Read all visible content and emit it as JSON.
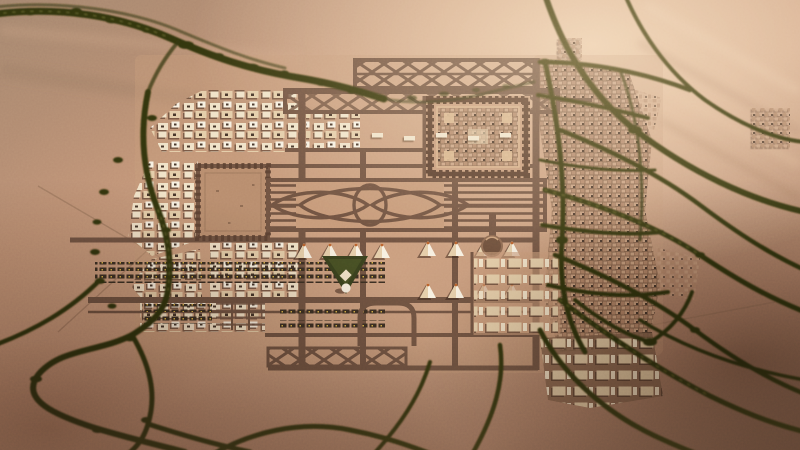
{
  "scene": {
    "title": "Aerial golden-hour view of a desert master-planned city: rectilinear new-town grid with walled citadel, ornamental garden band, tent rows and market strips, flanked by an organic old town and dark tree-lined wadi roads branching across the sand",
    "type": "aerial-photograph-render",
    "environment": "desert",
    "time_of_day": "golden hour"
  },
  "palette": {
    "desertLight": "#e9c6a4",
    "desertWarm": "#cda084",
    "desertBase": "#bb9078",
    "desertShade": "#8c6e5c",
    "desertDark": "#53392b",
    "road": "#6f5342",
    "roadDark": "#573e2f",
    "groundPad": "#c69a7a",
    "cream": "#f0e2c8",
    "creamSoft": "#e4cda9",
    "white": "#f7f0e1",
    "roof": "#45352a",
    "tan": "#c9a183",
    "tan2": "#b1876a",
    "oldBase": "#7e5f49",
    "green": "#31350f",
    "moss": "#5c5d26",
    "parkGreen": "#39411e",
    "plaza": "#b78c6e",
    "accentOrange": "#b9622d",
    "stallDark": "#3b2f23",
    "stallDot": "#d8b24a",
    "shadow": "rgba(58,39,27,0.55)",
    "wallLight": "#dcb78e"
  },
  "features": {
    "vegetation_band_top": "dark shrub band arcing along the north-west dunes",
    "west_wadi": "tree-lined wadi skirting the west edge of the grid",
    "delta_branches": "branching dark wadi channels fanning across the south-west desert",
    "highway_web": "curving tree-lined roads webbing the eastern desert",
    "citadel": "square crenellated-wall compound enclosing dense old fabric",
    "plaza": "large empty walled plaza",
    "braid_band": "striped garden band with interlaced ellipse parterre",
    "truss_bands": "criss-cross lattice road bands on the north edge",
    "tent_rows": "rows of white pavilion tents",
    "market_strips": "long stall rows dotted with awnings",
    "park_triangle": "green triangular park with white landmark",
    "dome_landmark": "round domed landmark on a stem road",
    "warehouse_grid": "grid of pale warehouse slabs",
    "old_town": "fine-grain organic city fabric on the east side",
    "bright_quarter": "sunlit pale block quarter at the old town's south",
    "hatch_band": "diagonal-hatch road band on the south edge"
  }
}
